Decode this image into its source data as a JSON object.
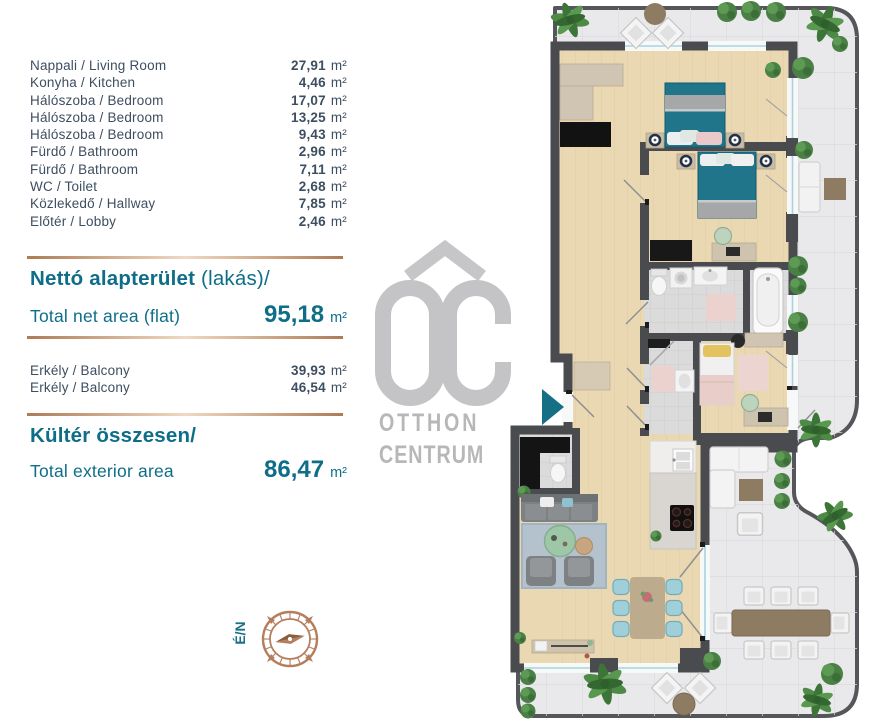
{
  "panel": {
    "unit": "m²",
    "rooms": [
      {
        "label": "Nappali / Living Room",
        "value": "27,91"
      },
      {
        "label": "Konyha / Kitchen",
        "value": "4,46"
      },
      {
        "label": "Hálószoba / Bedroom",
        "value": "17,07"
      },
      {
        "label": "Hálószoba / Bedroom",
        "value": "13,25"
      },
      {
        "label": "Hálószoba / Bedroom",
        "value": "9,43"
      },
      {
        "label": "Fürdő / Bathroom",
        "value": "2,96"
      },
      {
        "label": "Fürdő / Bathroom",
        "value": "7,11"
      },
      {
        "label": "WC / Toilet",
        "value": "2,68"
      },
      {
        "label": "Közlekedő / Hallway",
        "value": "7,85"
      },
      {
        "label": "Előtér / Lobby",
        "value": "2,46"
      }
    ],
    "net_area": {
      "title_hu": "Nettó alapterület",
      "title_hu_suffix": " (lakás)/",
      "title_en": "Total net area (flat)",
      "value": "95,18"
    },
    "balconies": [
      {
        "label": "Erkély / Balcony",
        "value": "39,93"
      },
      {
        "label": "Erkély / Balcony",
        "value": "46,54"
      }
    ],
    "exterior": {
      "title_hu": "Kültér összesen/",
      "title_en": "Total exterior area",
      "value": "86,47"
    },
    "compass_label": "É/N"
  },
  "logo": {
    "mark": "OC",
    "line1": "OTTHON",
    "line2": "CENTRUM"
  },
  "colors": {
    "accent_teal": "#0e6e88",
    "text_navy": "#3d4e60",
    "divider_copper": "#ad7c55",
    "logo_gray": "#c4c4c6",
    "compass_copper": "#b47e5c",
    "entrance_teal": "#156f85"
  }
}
